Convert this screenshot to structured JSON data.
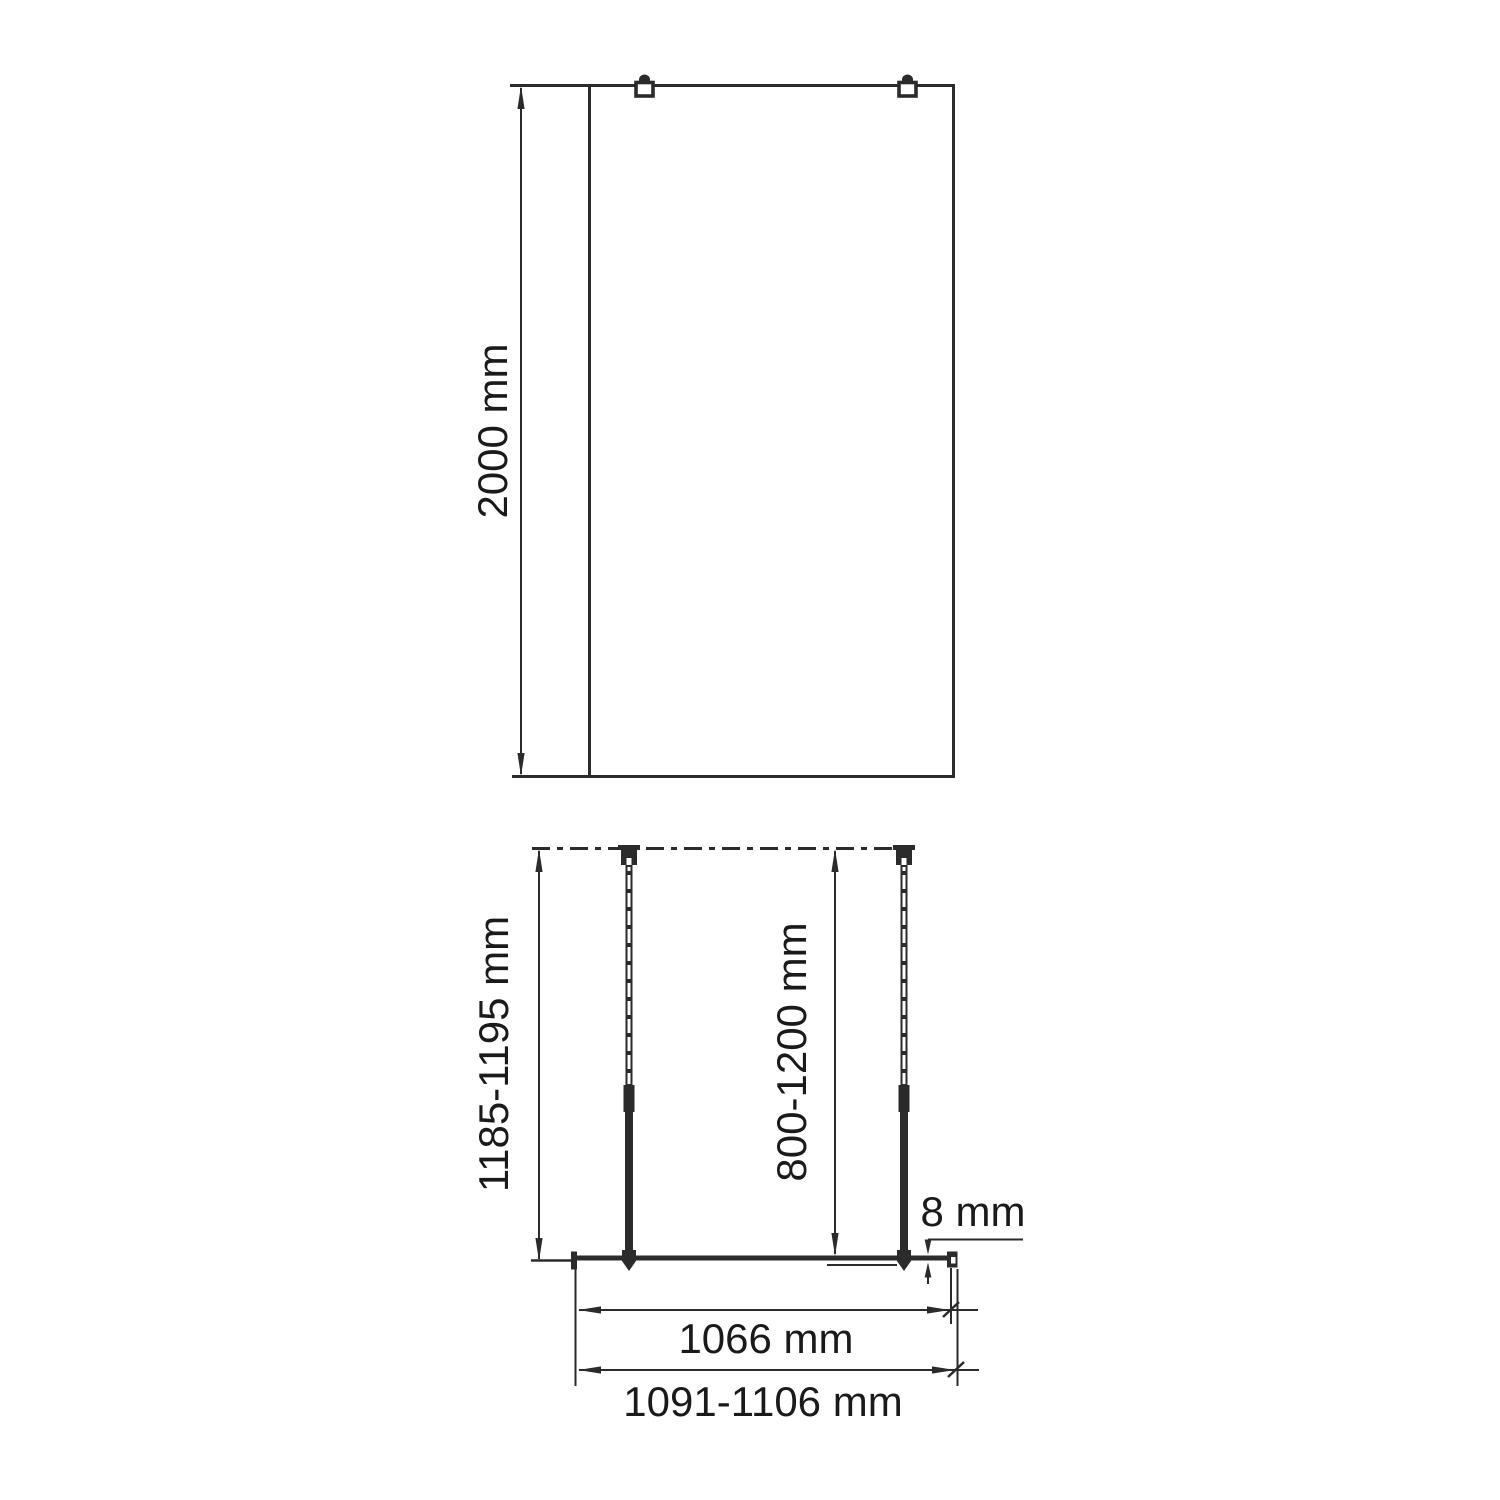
{
  "colors": {
    "line": "#2b2b2b",
    "text": "#1a1a1a",
    "background": "#ffffff"
  },
  "front_view": {
    "height_label": "2000 mm"
  },
  "plan_view": {
    "bar_length_label": "1185-1195 mm",
    "wall_distance_label": "800-1200 mm",
    "glass_thickness_label": "8 mm",
    "glass_width_label": "1066 mm",
    "overall_width_label": "1091-1106 mm"
  }
}
